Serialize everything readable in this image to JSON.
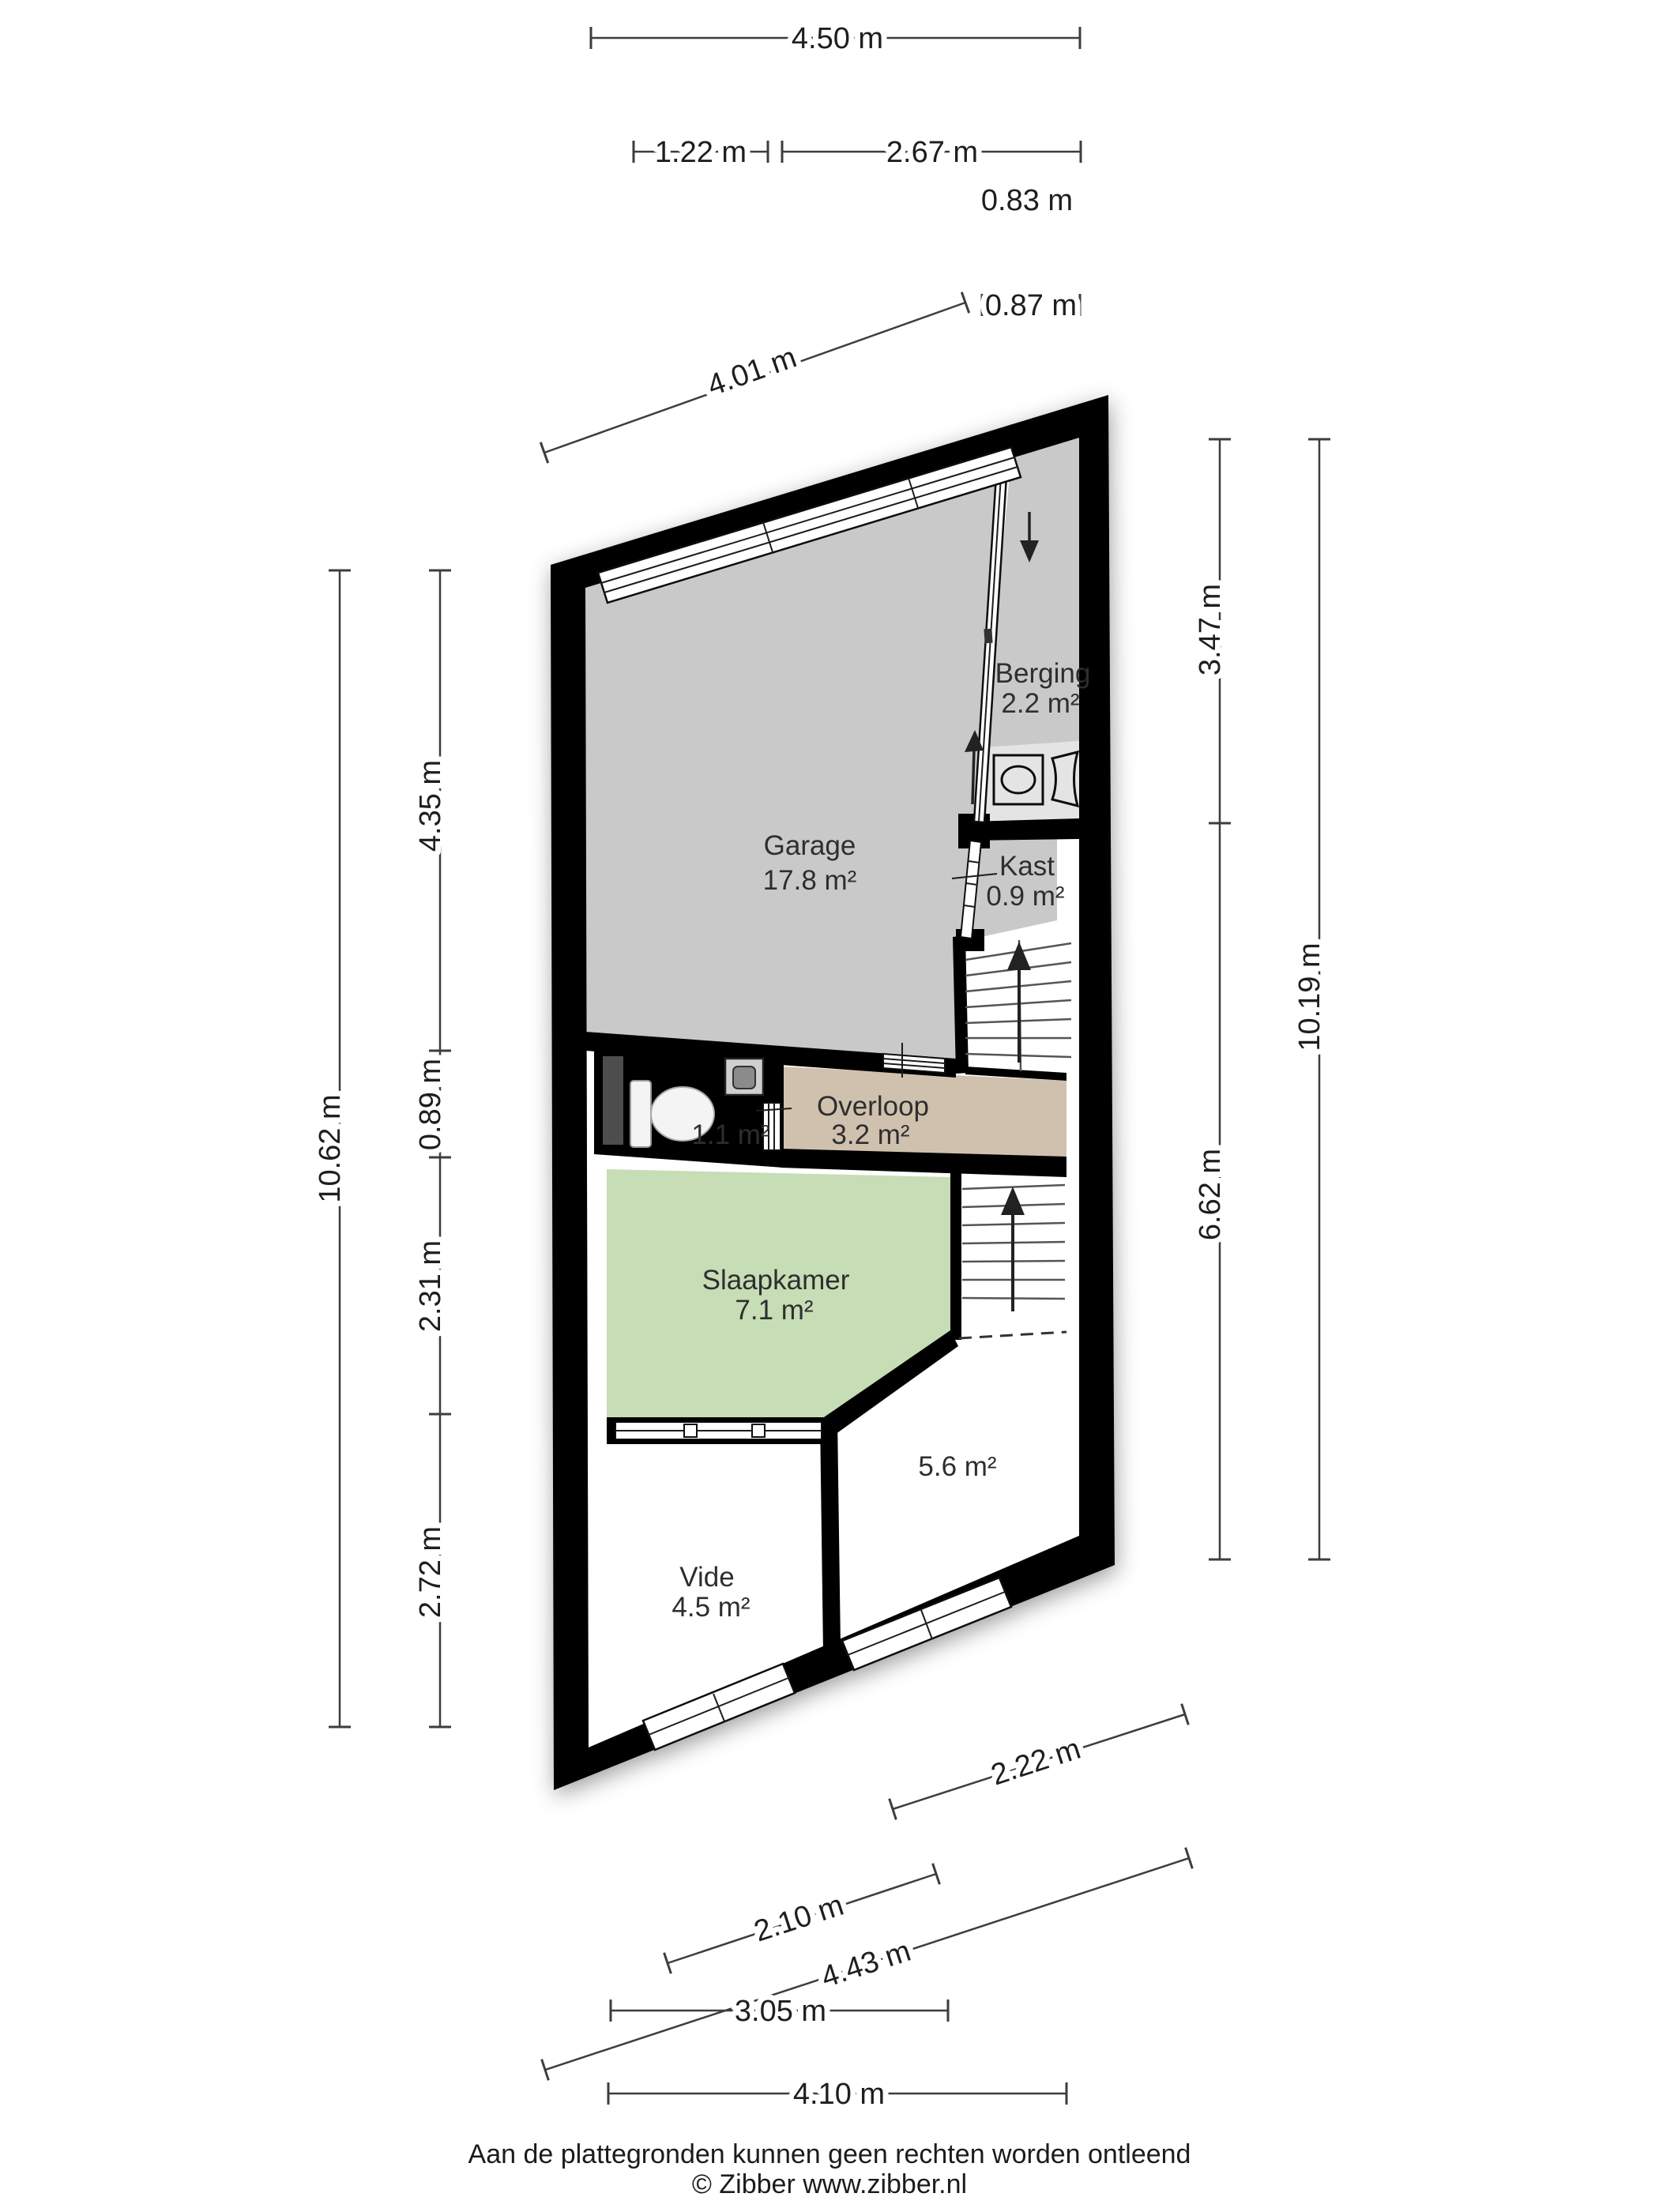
{
  "plan": {
    "rooms": {
      "garage": {
        "name": "Garage",
        "area": "17.8 m²",
        "color": "#c9c9c9"
      },
      "berging": {
        "name": "Berging",
        "area": "2.2 m²",
        "color": "#c9c9c9"
      },
      "kast": {
        "name": "Kast",
        "area": "0.9 m²",
        "color": "#c9c9c9"
      },
      "overloop": {
        "name": "Overloop",
        "area": "3.2 m²",
        "color": "#d0c1ae"
      },
      "toilet": {
        "area": "1.1 m²",
        "color": "#a8c2de"
      },
      "slaapkamer": {
        "name": "Slaapkamer",
        "area": "7.1 m²",
        "color": "#c6ddb5"
      },
      "room_5_6": {
        "area": "5.6 m²",
        "color": "#ffffff"
      },
      "vide": {
        "name": "Vide",
        "area": "4.5 m²",
        "color": "#ffffff"
      }
    },
    "icons": {
      "washer": "washing-machine-icon",
      "laundry_basket": "laundry-basket-icon",
      "toilet": "toilet-icon",
      "sink": "sink-icon",
      "stairs_up": "stairs-up-arrow-icon",
      "stairs_down": "stairs-down-arrow-icon"
    },
    "wall_color": "#000000"
  },
  "dimensions": {
    "top": {
      "d450": "4.50 m",
      "d122": "1.22 m",
      "d267": "2.67 m",
      "d083": "0.83 m",
      "d087": "0.87 m",
      "d401": "4.01 m"
    },
    "left": {
      "d1062": "10.62 m",
      "d435": "4.35 m",
      "d089": "0.89 m",
      "d231": "2.31 m",
      "d272": "2.72 m"
    },
    "right": {
      "d347": "3.47 m",
      "d662": "6.62 m",
      "d1019": "10.19 m"
    },
    "bottom": {
      "d222": "2.22 m",
      "d210": "2.10 m",
      "d443": "4.43 m",
      "d305": "3.05 m",
      "d410": "4.10 m"
    }
  },
  "footer": {
    "disclaimer": "Aan de plattegronden kunnen geen rechten worden ontleend",
    "copyright": "© Zibber www.zibber.nl"
  }
}
